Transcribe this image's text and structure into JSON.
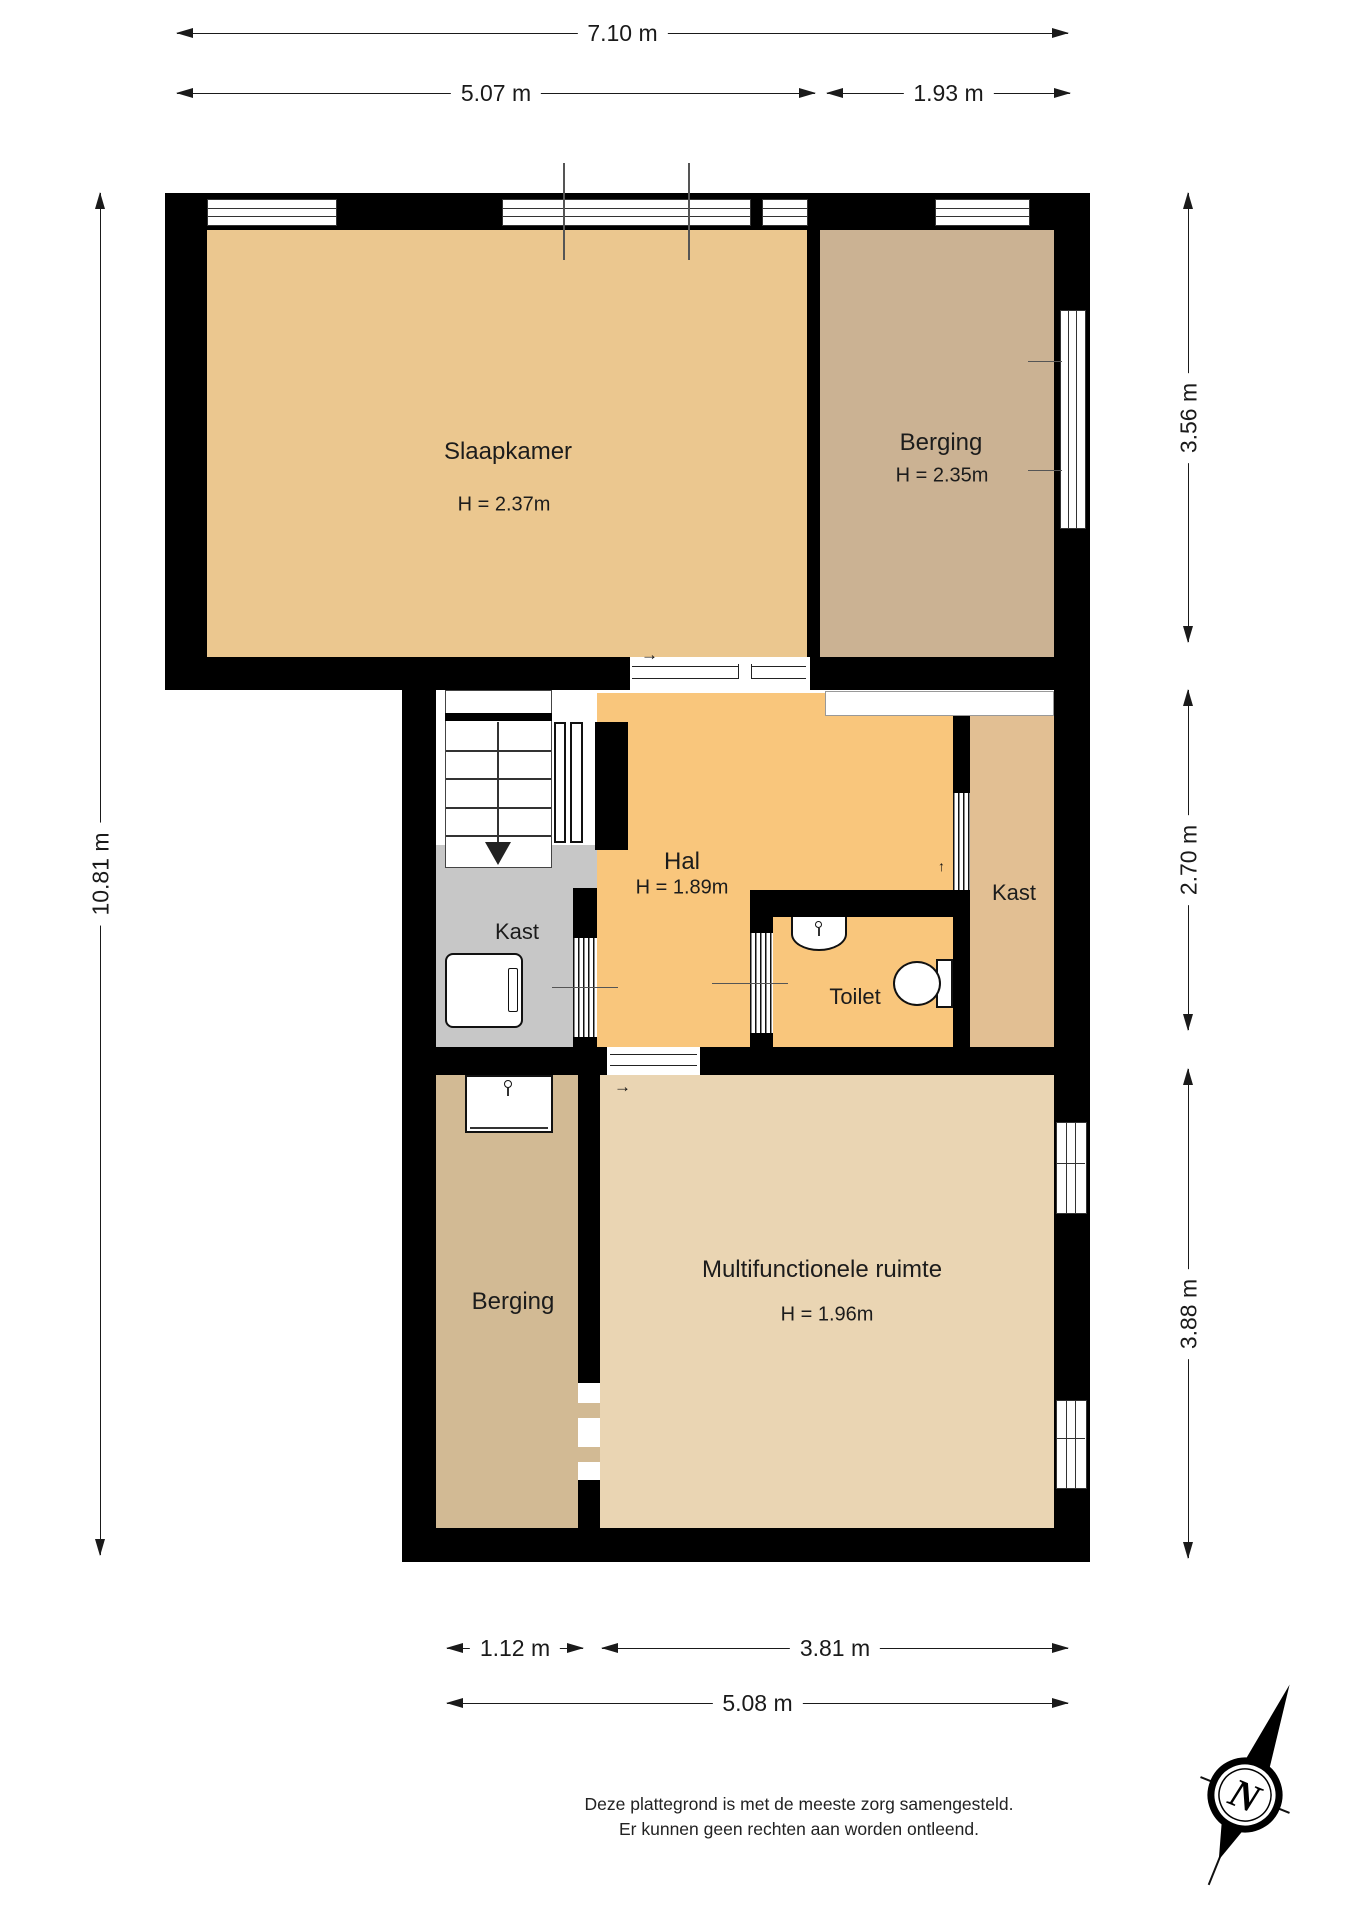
{
  "title": "Plattegrond",
  "rooms": {
    "slaapkamer": {
      "name": "Slaapkamer",
      "height": "H = 2.37m"
    },
    "berging_top": {
      "name": "Berging",
      "height": "H = 2.35m"
    },
    "hal": {
      "name": "Hal",
      "height": "H = 1.89m"
    },
    "kast_left": {
      "name": "Kast"
    },
    "toilet": {
      "name": "Toilet"
    },
    "kast_right": {
      "name": "Kast"
    },
    "berging_bottom": {
      "name": "Berging"
    },
    "multifunctionele": {
      "name": "Multifunctionele ruimte",
      "height": "H = 1.96m"
    }
  },
  "dimensions": {
    "top_total": "7.10 m",
    "top_left": "5.07 m",
    "top_right": "1.93 m",
    "left_total": "10.81 m",
    "right_top": "3.56 m",
    "right_middle": "2.70 m",
    "right_bottom": "3.88 m",
    "bottom_left": "1.12 m",
    "bottom_right": "3.81 m",
    "bottom_total": "5.08 m"
  },
  "door_symbols": {
    "slaapkamer_slide": "→",
    "multi_slide": "→",
    "kast_right_swing": "↑",
    "stairs_direction": "down"
  },
  "compass": {
    "label": "N"
  },
  "disclaimer": {
    "line1": "Deze plattegrond is met de meeste zorg samengesteld.",
    "line2": "Er kunnen geen rechten aan worden ontleend."
  },
  "colors": {
    "slaapkamer": "#ebc78f",
    "berging_top": "#cbb293",
    "hal": "#f9c67c",
    "kast_left": "#c7c7c7",
    "toilet": "#cedded",
    "kast_right": "#e2bf93",
    "berging_bottom": "#d2ba94",
    "multifunctionele": "#ead5b3",
    "wall": "#000000"
  }
}
